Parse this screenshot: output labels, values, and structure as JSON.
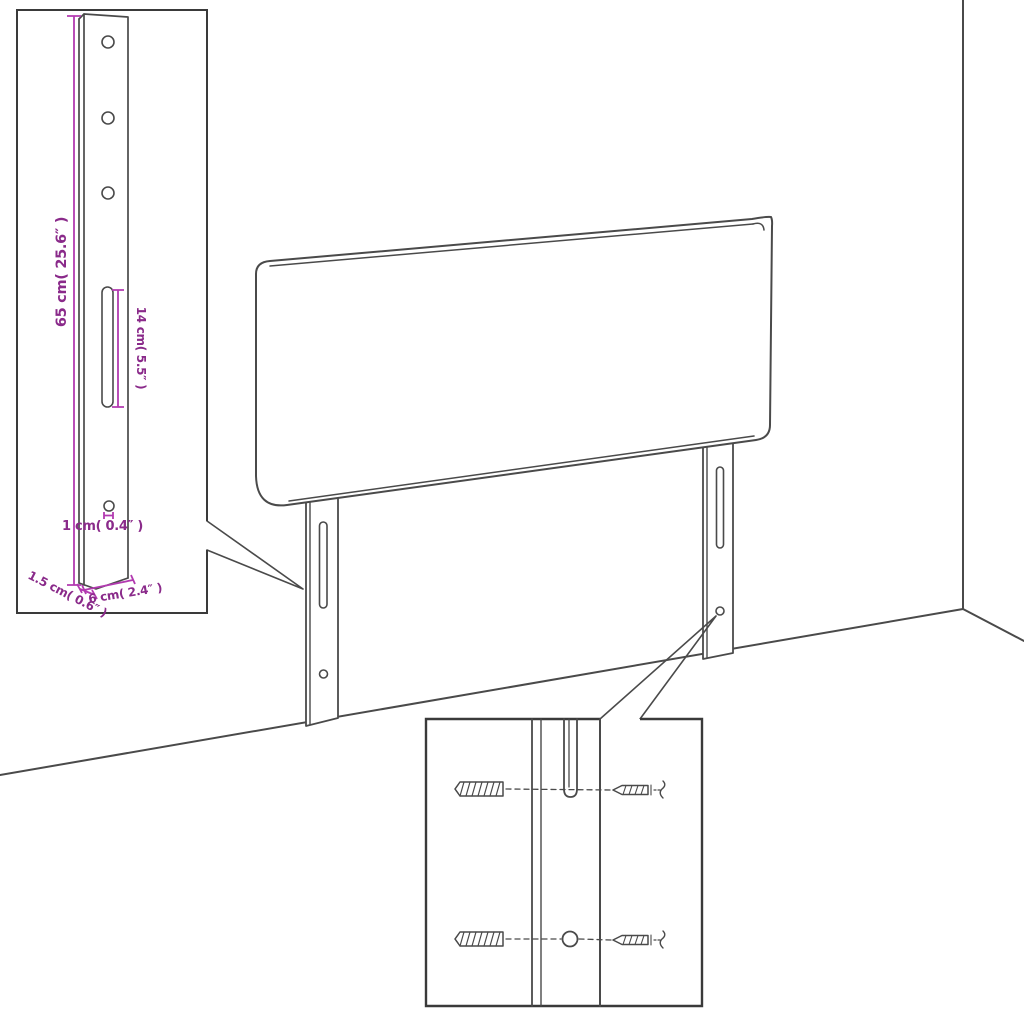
{
  "page": {
    "background": "#ffffff",
    "description": "Assembly diagram of a wall-mounted headboard with two mounting legs, a detail inset of one leg with dimensions, and a magnified inset showing wall-plug and screw mounting"
  },
  "colors": {
    "ink": "#4a4a4a",
    "ink-dark": "#3a3a3a",
    "annotation-line": "#b23ab0",
    "annotation-text": "#8a2a8a"
  },
  "leg_detail_inset": {
    "dim_height_label": "65 cm( 25.6″ )",
    "dim_slot_label": "14 cm( 5.5″ )",
    "dim_hole_label": "1 cm( 0.4″ )",
    "dim_thickness_label": "1.5 cm( 0.6″ )",
    "dim_width_label": "6 cm( 2.4″ )"
  }
}
